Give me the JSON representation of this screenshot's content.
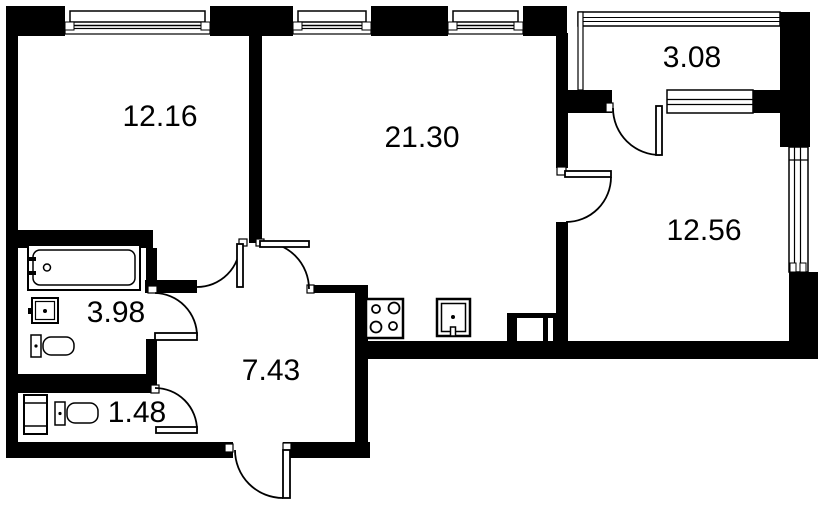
{
  "rooms": [
    {
      "id": "bedroom",
      "area": "12.16"
    },
    {
      "id": "kitchen-living",
      "area": "21.30"
    },
    {
      "id": "balcony",
      "area": "3.08"
    },
    {
      "id": "bedroom-2",
      "area": "12.56"
    },
    {
      "id": "bathroom",
      "area": "3.98"
    },
    {
      "id": "hallway",
      "area": "7.43"
    },
    {
      "id": "wc",
      "area": "1.48"
    }
  ],
  "colors": {
    "wall": "#000000",
    "background": "#ffffff",
    "label_text": "#000000"
  },
  "icons": [
    "bathtub-icon",
    "bath-sink-icon",
    "toilet-icon",
    "washing-machine-icon",
    "stove-icon",
    "kitchen-sink-icon",
    "vent-shaft-icon",
    "door-swing-icon",
    "window-icon"
  ]
}
